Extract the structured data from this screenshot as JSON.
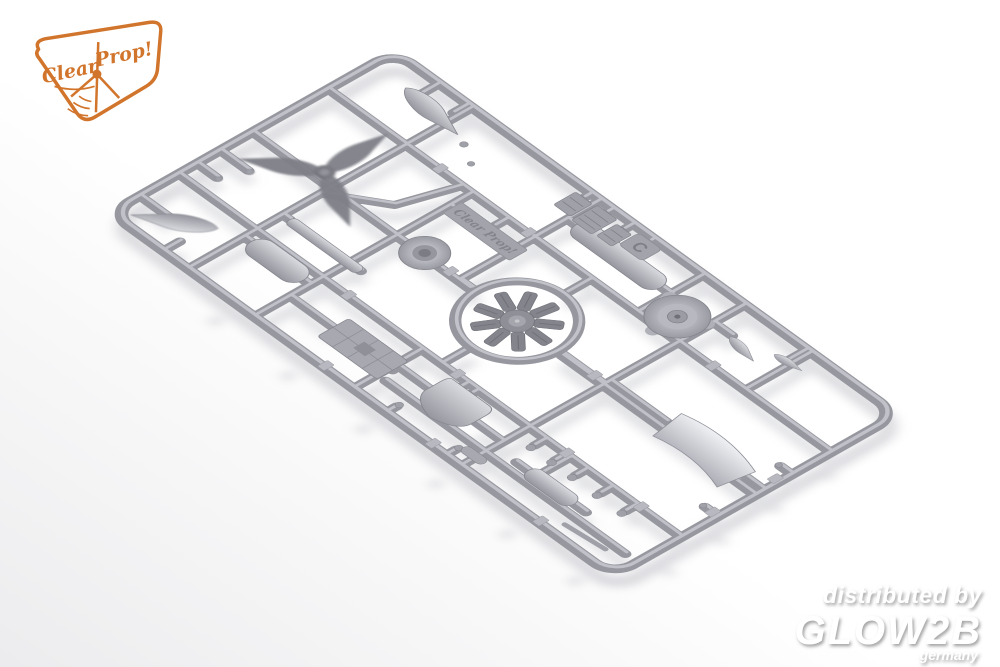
{
  "photo": {
    "subject": "Gray plastic injection-molded model aircraft sprue photographed at an angle on a white background",
    "background_color": "#ffffff",
    "shadow_color": "#c2c3c9"
  },
  "logo": {
    "brand_first": "Clear",
    "brand_second": "Prop!",
    "color": "#d2752c"
  },
  "sprue": {
    "plastic_color": "#9b9ca3",
    "plastic_highlight": "#c9cad1",
    "plastic_dark": "#83848c",
    "letter_tab": "C",
    "molded_brand": "Clear Prop!",
    "parts": [
      "three-blade-propeller",
      "propeller-blade",
      "spinner-cone",
      "drop-tank",
      "wing-strip",
      "radial-engine",
      "engine-mount-ring",
      "cowling-front-disc",
      "wheel-hub-disc",
      "instrument-panel-cluster",
      "cockpit-floor",
      "bulkhead-shield",
      "curved-canopy-panel",
      "exhaust-stubs",
      "small-pin-parts",
      "part-number-tabs"
    ]
  },
  "watermark": {
    "line1": "distributed by",
    "brand": "GLOW2B",
    "country": "germany",
    "color": "#ffffff"
  }
}
